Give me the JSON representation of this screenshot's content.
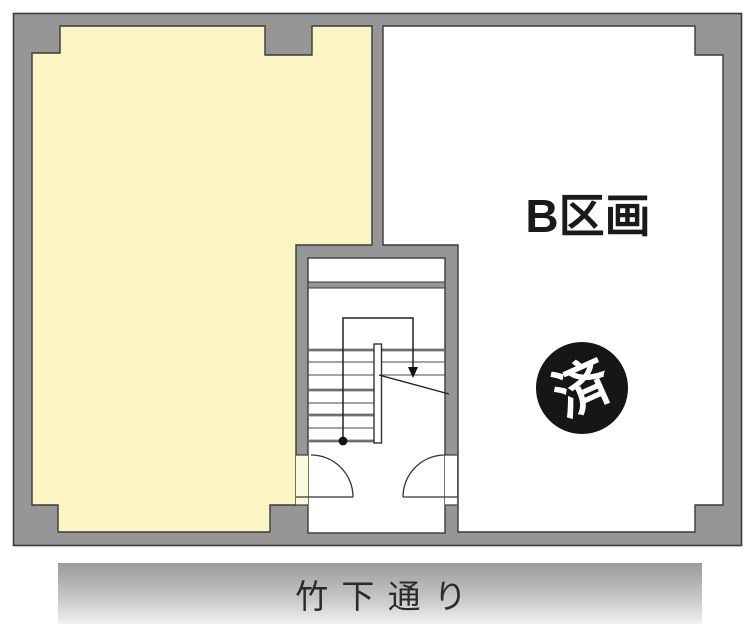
{
  "plan": {
    "unit_b_label": "B区画",
    "sold_badge": "済",
    "street_name": "竹 下 通 り"
  },
  "colors": {
    "wall": "#969696",
    "outline": "#3a3a3a",
    "unit_a": "#FBF5C3",
    "unit_b": "#FFFFFF",
    "door_gap_a": "#FCF8DB",
    "door_gap_b": "#FFFFFF",
    "badge_bg": "#161616",
    "badge_text": "#FFFFFF",
    "street_top": "#9B9B9B",
    "street_bottom": "#F2F2F2"
  }
}
